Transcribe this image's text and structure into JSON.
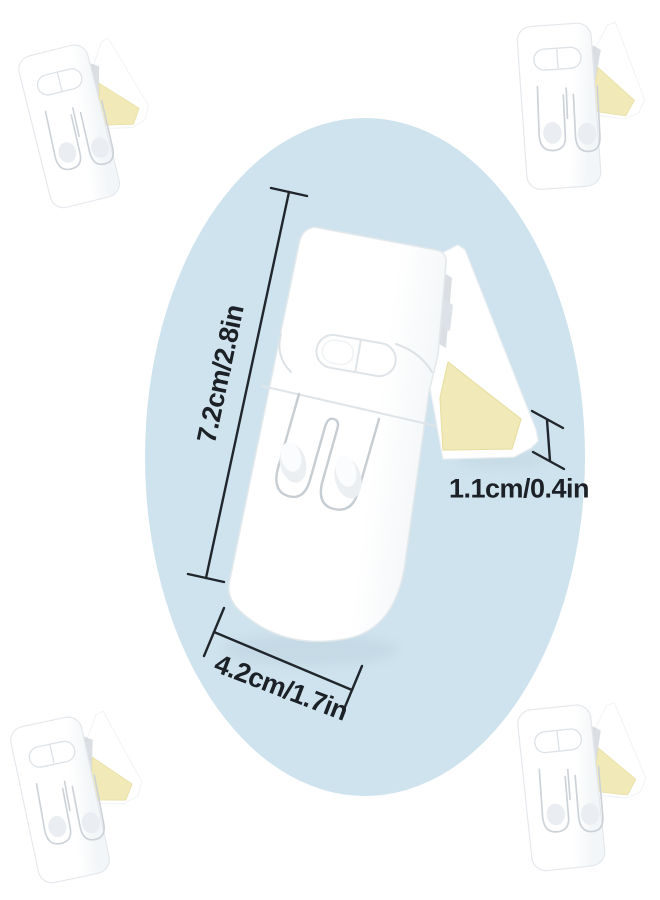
{
  "diagram": {
    "dimensions": {
      "height_label": "7.2cm/2.8in",
      "depth_label": "1.1cm/0.4in",
      "width_label": "4.2cm/1.7in"
    },
    "colors": {
      "background": "#ffffff",
      "circle_fill": "#cfe3ee",
      "product_body": "#ffffff",
      "adhesive_pad": "#f1eab8",
      "annotation": "#20262c"
    },
    "icons": {
      "main_product": "child-safety-lock-illustration",
      "corner_products": "child-safety-lock-thumbnail"
    }
  }
}
